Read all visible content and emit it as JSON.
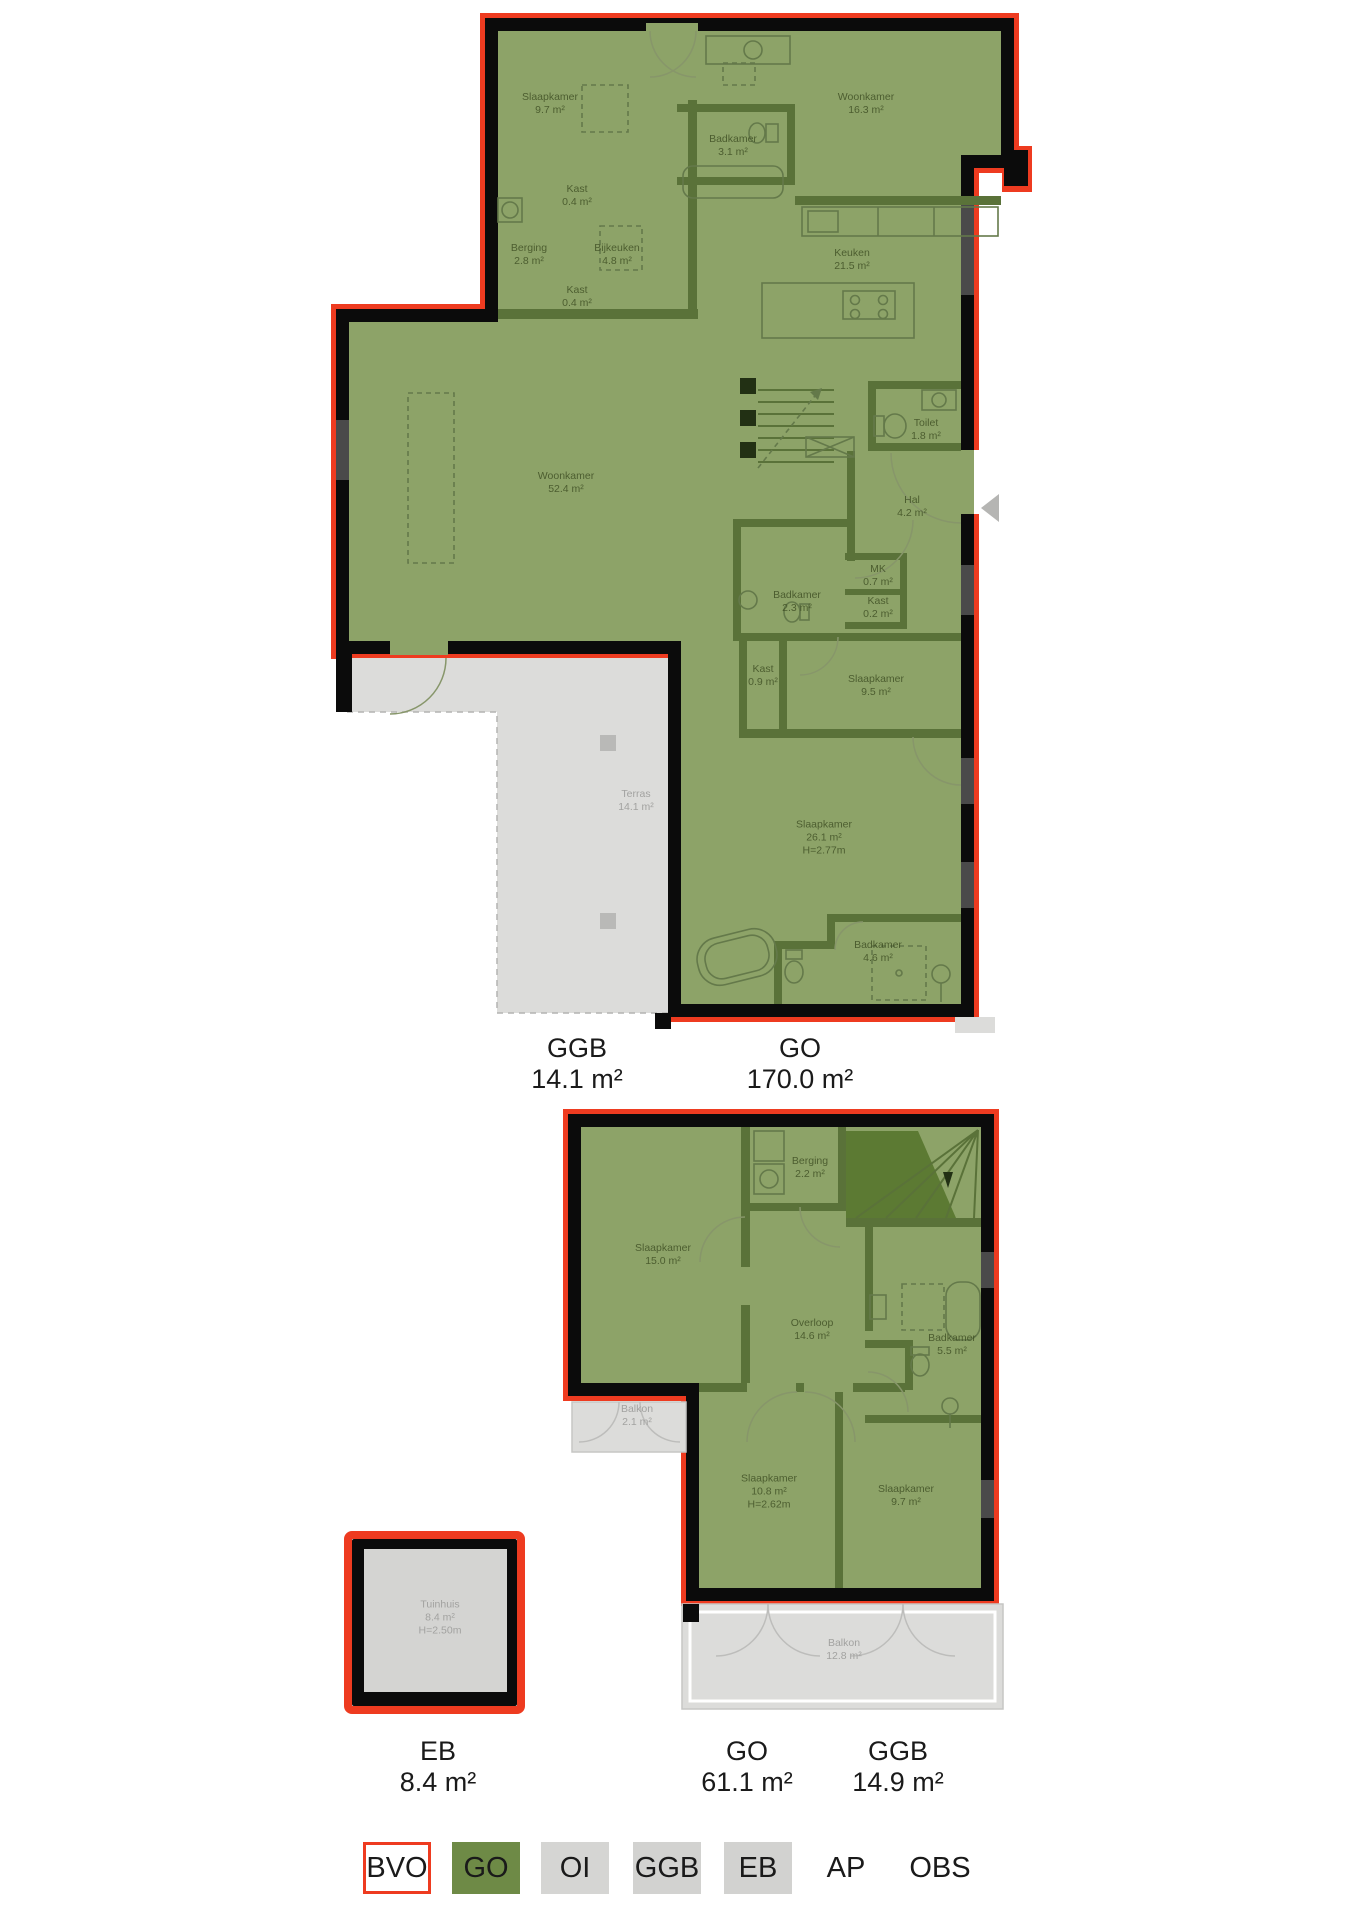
{
  "colors": {
    "background": "#ffffff",
    "go_fill": "#8da368",
    "go_legend": "#6e8a46",
    "wall_black": "#0b0b0b",
    "outline_red": "#ee3b20",
    "wall_interior": "#5a7239",
    "stairs_dark": "#5c7a33",
    "ggb_fill": "#dcdcda",
    "eb_fill": "#d4d4d2",
    "legend_gray": "#d2d2d0",
    "room_label": "#3c4c22",
    "gray_label": "#a2a2a0",
    "text_dark": "#1a1a1a",
    "window_gray": "#4a4a4a",
    "door_arc": "#87966a",
    "arrow_gray": "#b5b5b3"
  },
  "floorplan1": {
    "rooms": [
      {
        "lines": [
          "Slaapkamer",
          "9.7 m²"
        ],
        "x": 550,
        "y": 104
      },
      {
        "lines": [
          "Woonkamer",
          "16.3 m²"
        ],
        "x": 866,
        "y": 104
      },
      {
        "lines": [
          "Badkamer",
          "3.1 m²"
        ],
        "x": 733,
        "y": 146
      },
      {
        "lines": [
          "Kast",
          "0.4 m²"
        ],
        "x": 577,
        "y": 196
      },
      {
        "lines": [
          "Berging",
          "2.8 m²"
        ],
        "x": 529,
        "y": 255
      },
      {
        "lines": [
          "Bijkeuken",
          "4.8 m²"
        ],
        "x": 617,
        "y": 255
      },
      {
        "lines": [
          "Kast",
          "0.4 m²"
        ],
        "x": 577,
        "y": 297
      },
      {
        "lines": [
          "Keuken",
          "21.5 m²"
        ],
        "x": 852,
        "y": 260
      },
      {
        "lines": [
          "Woonkamer",
          "52.4 m²"
        ],
        "x": 566,
        "y": 483
      },
      {
        "lines": [
          "Toilet",
          "1.8 m²"
        ],
        "x": 926,
        "y": 430
      },
      {
        "lines": [
          "Hal",
          "4.2 m²"
        ],
        "x": 912,
        "y": 507
      },
      {
        "lines": [
          "MK",
          "0.7 m²"
        ],
        "x": 878,
        "y": 576
      },
      {
        "lines": [
          "Kast",
          "0.2 m²"
        ],
        "x": 878,
        "y": 608
      },
      {
        "lines": [
          "Badkamer",
          "2.3 m²"
        ],
        "x": 797,
        "y": 602
      },
      {
        "lines": [
          "Kast",
          "0.9 m²"
        ],
        "x": 763,
        "y": 676
      },
      {
        "lines": [
          "Slaapkamer",
          "9.5 m²"
        ],
        "x": 876,
        "y": 686
      },
      {
        "lines": [
          "Terras",
          "14.1 m²"
        ],
        "x": 636,
        "y": 801,
        "gray": true
      },
      {
        "lines": [
          "Slaapkamer",
          "26.1 m²",
          "H=2.77m"
        ],
        "x": 824,
        "y": 838
      },
      {
        "lines": [
          "Badkamer",
          "4.6 m²"
        ],
        "x": 878,
        "y": 952
      }
    ],
    "area_labels": [
      {
        "code": "GGB",
        "value": "14.1 m²",
        "x": 577,
        "y": 1033
      },
      {
        "code": "GO",
        "value": "170.0 m²",
        "x": 800,
        "y": 1033
      }
    ]
  },
  "floorplan2": {
    "rooms": [
      {
        "lines": [
          "Berging",
          "2.2 m²"
        ],
        "x": 810,
        "y": 1168
      },
      {
        "lines": [
          "Slaapkamer",
          "15.0 m²"
        ],
        "x": 663,
        "y": 1255
      },
      {
        "lines": [
          "Overloop",
          "14.6 m²"
        ],
        "x": 812,
        "y": 1330
      },
      {
        "lines": [
          "Badkamer",
          "5.5 m²"
        ],
        "x": 952,
        "y": 1345
      },
      {
        "lines": [
          "Balkon",
          "2.1 m²"
        ],
        "x": 637,
        "y": 1416,
        "gray": true
      },
      {
        "lines": [
          "Slaapkamer",
          "10.8 m²",
          "H=2.62m"
        ],
        "x": 769,
        "y": 1492
      },
      {
        "lines": [
          "Slaapkamer",
          "9.7 m²"
        ],
        "x": 906,
        "y": 1496
      },
      {
        "lines": [
          "Balkon",
          "12.8 m²"
        ],
        "x": 844,
        "y": 1650,
        "gray": true
      }
    ],
    "area_labels": [
      {
        "code": "EB",
        "value": "8.4 m²",
        "x": 438,
        "y": 1736
      },
      {
        "code": "GO",
        "value": "61.1 m²",
        "x": 747,
        "y": 1736
      },
      {
        "code": "GGB",
        "value": "14.9 m²",
        "x": 898,
        "y": 1736
      }
    ]
  },
  "tuinhuis": {
    "label": {
      "lines": [
        "Tuinhuis",
        "8.4 m²",
        "H=2.50m"
      ],
      "x": 440,
      "y": 1618,
      "gray": true
    }
  },
  "legend": {
    "items": [
      {
        "label": "BVO",
        "box": "outline",
        "x": 363
      },
      {
        "label": "GO",
        "box": "green",
        "x": 452
      },
      {
        "label": "OI",
        "box": "gray-light",
        "x": 541
      },
      {
        "label": "GGB",
        "box": "gray",
        "x": 633
      },
      {
        "label": "EB",
        "box": "gray",
        "x": 724
      },
      {
        "label": "AP",
        "box": "none",
        "x": 812
      },
      {
        "label": "OBS",
        "box": "none",
        "x": 906
      }
    ]
  }
}
